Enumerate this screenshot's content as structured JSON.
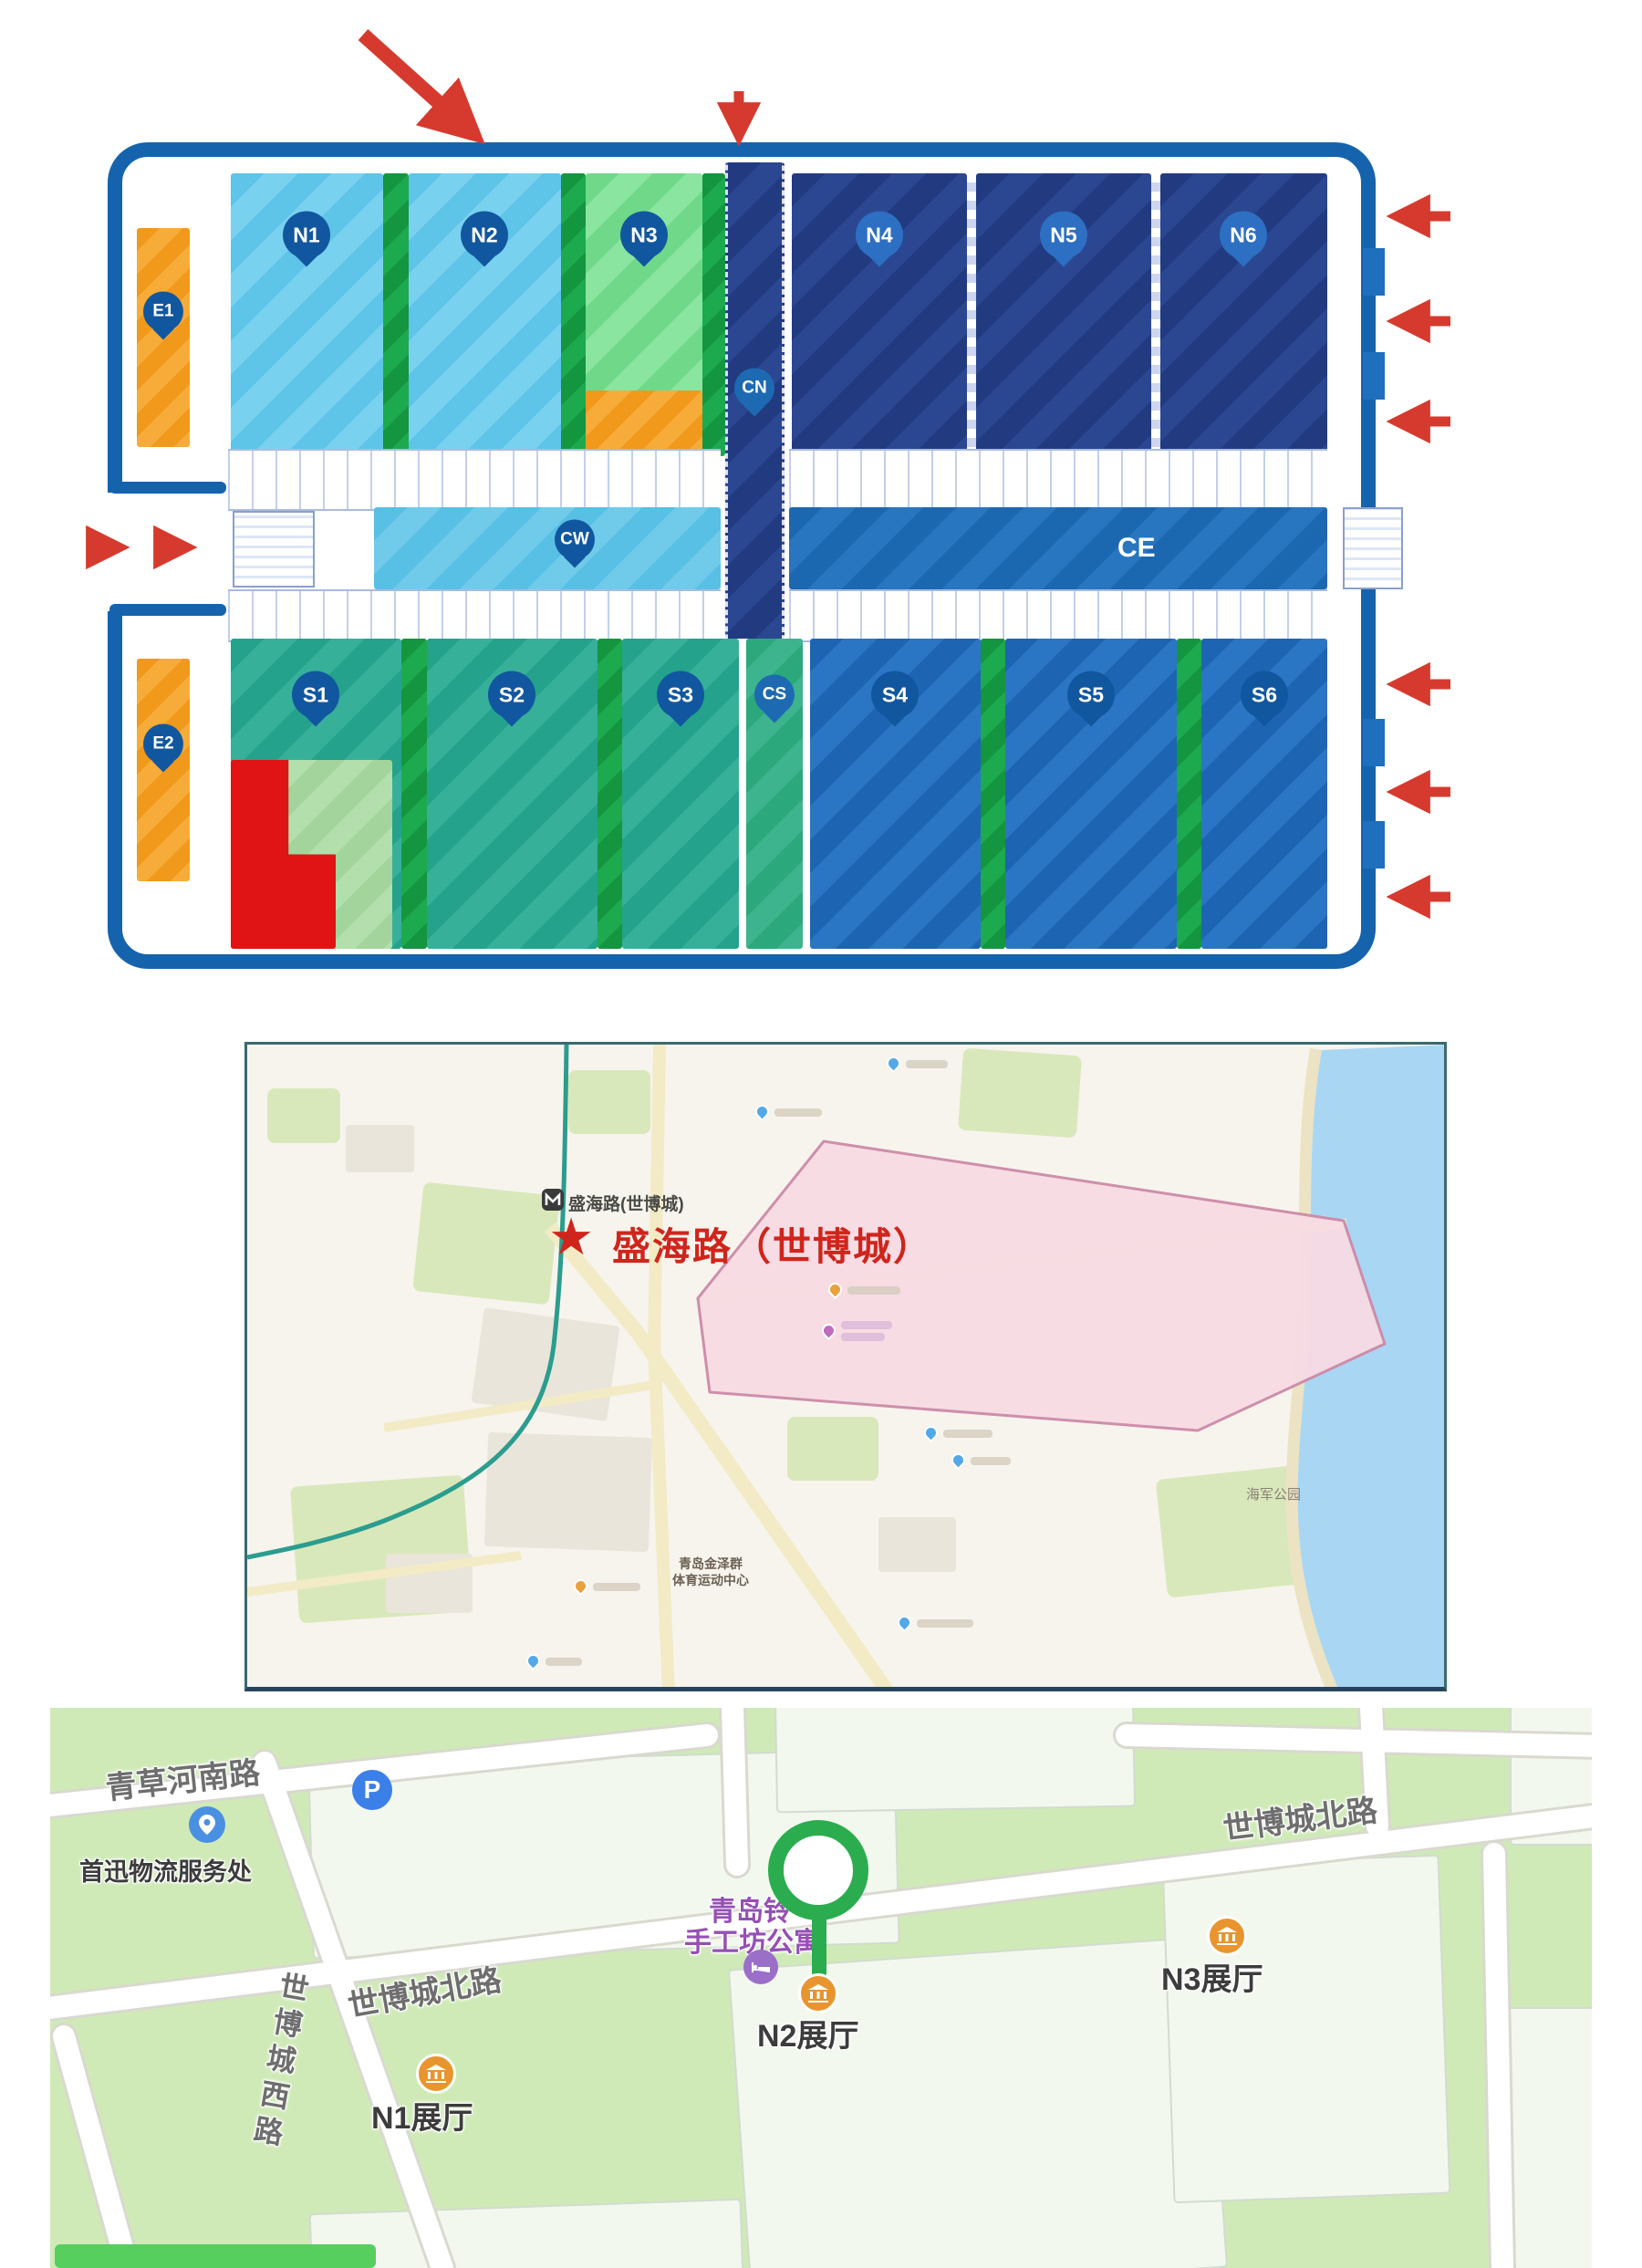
{
  "floor_plan": {
    "north_halls": {
      "n1": "N1",
      "n2": "N2",
      "n3": "N3",
      "n4": "N4",
      "n5": "N5",
      "n6": "N6"
    },
    "south_halls": {
      "s1": "S1",
      "s2": "S2",
      "s3": "S3",
      "s4": "S4",
      "s5": "S5",
      "s6": "S6"
    },
    "east_halls": {
      "e1": "E1",
      "e2": "E2"
    },
    "corridors": {
      "cn": "CN",
      "cw": "CW",
      "ce": "CE",
      "cs": "CS"
    }
  },
  "metro_map": {
    "star": "★",
    "station_title": "盛海路（世博城）",
    "station_tag": "盛海路(世博城)",
    "sports_center_line1": "青岛金泽群",
    "sports_center_line2": "体育运动中心",
    "park_label": "海军公园"
  },
  "street_map": {
    "road_qingcao": "青草河南路",
    "road_north": "世博城北路",
    "road_west": "世博城西路",
    "poi_logistics": "首迅物流服务处",
    "poi_apartment_line1": "青岛铃",
    "poi_apartment_line2": "手工坊公寓",
    "hall_n1": "N1展厅",
    "hall_n2": "N2展厅",
    "hall_n3": "N3展厅",
    "parking_letter": "P"
  },
  "colors": {
    "venue_border": "#1563ad",
    "hall_light_blue": "#5ec4e8",
    "hall_navy": "#223a80",
    "hall_teal": "#24a28b",
    "hall_south_blue": "#1d65b2",
    "hall_light_green": "#6fd989",
    "divider_green": "#149540",
    "east_orange": "#f0991a",
    "arrow_red": "#d63a2e",
    "star_red": "#d0251c",
    "expo_pink": "#f8dbe4",
    "metro_teal": "#2a9d8f",
    "marker_green": "#2bad4f",
    "poi_orange": "#e8952f",
    "poi_purple": "#9550b4",
    "parking_blue": "#3b7fe8",
    "map_green_bg": "#cfeab7"
  }
}
